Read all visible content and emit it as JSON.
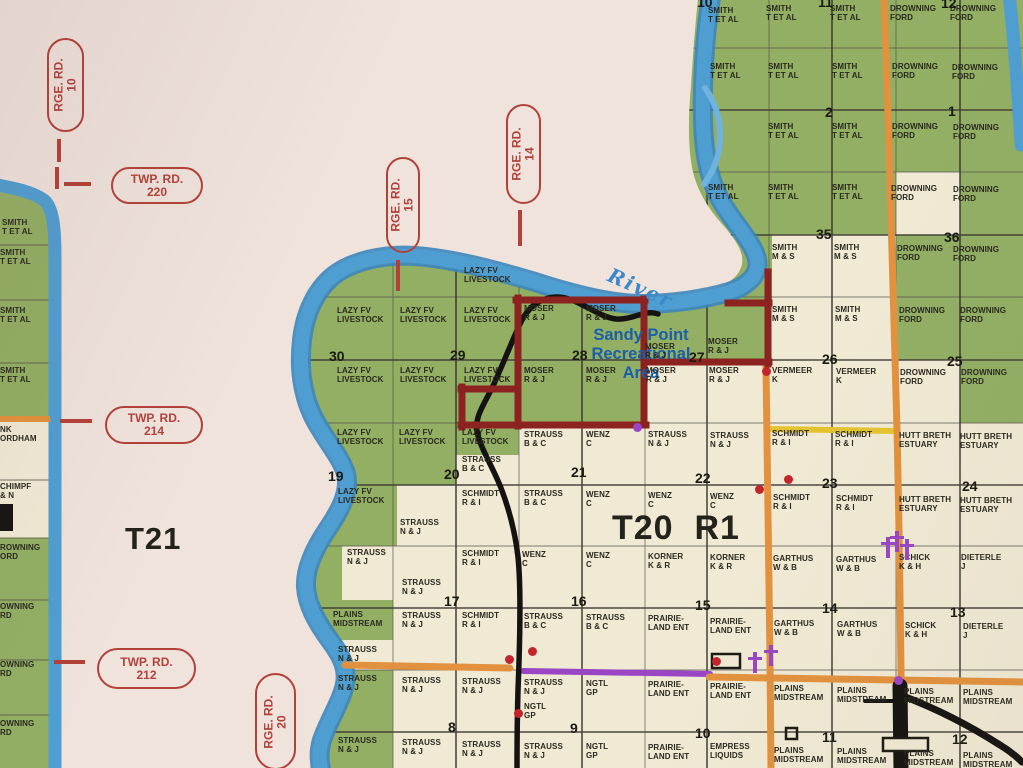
{
  "colors": {
    "paper": "#efe3dc",
    "cream": "#f0ead5",
    "green": "#92af64",
    "river": "#4f9ed2",
    "river_edge": "#3d86bd",
    "river_light": "#6fb3de",
    "grid": "#565349",
    "section_line": "#35332c",
    "orange": "#e2923e",
    "yellow": "#e3c32f",
    "purple": "#9a45c4",
    "black_road": "#151311",
    "boundary": "#8c2320",
    "oval": "#b2413a",
    "label": "#2a291f",
    "blue_text": "#1a5fa8",
    "river_text": "#3c88c8",
    "dot_red": "#c4242b"
  },
  "map": {
    "t21": "T21",
    "t20r1": "T20  R1",
    "sandy_point": [
      "Sandy Point",
      "Recreational",
      "Area"
    ],
    "river_label": "River",
    "road_ovals": [
      {
        "o": "v",
        "x": 47,
        "y": 38,
        "w": 37,
        "h": 94,
        "l1": "RGE. RD.",
        "l2": "10"
      },
      {
        "o": "h",
        "x": 111,
        "y": 167,
        "w": 92,
        "h": 37,
        "l1": "TWP. RD.",
        "l2": "220"
      },
      {
        "o": "v",
        "x": 386,
        "y": 157,
        "w": 34,
        "h": 96,
        "l1": "RGE. RD.",
        "l2": "15"
      },
      {
        "o": "v",
        "x": 506,
        "y": 104,
        "w": 35,
        "h": 100,
        "l1": "RGE. RD.",
        "l2": "14"
      },
      {
        "o": "h",
        "x": 105,
        "y": 406,
        "w": 98,
        "h": 38,
        "l1": "TWP. RD.",
        "l2": "214"
      },
      {
        "o": "h",
        "x": 97,
        "y": 648,
        "w": 99,
        "h": 41,
        "l1": "TWP. RD.",
        "l2": "212"
      },
      {
        "o": "v",
        "x": 255,
        "y": 673,
        "w": 41,
        "h": 97,
        "l1": "RGE. RD.",
        "l2": "20"
      }
    ],
    "dashes": [
      [
        57,
        139,
        4,
        23
      ],
      [
        55,
        167,
        4,
        22
      ],
      [
        64,
        182,
        27,
        4
      ],
      [
        396,
        260,
        4,
        31
      ],
      [
        518,
        210,
        4,
        36
      ],
      [
        60,
        419,
        32,
        4
      ],
      [
        54,
        660,
        31,
        4
      ]
    ],
    "orange_tick": [
      0,
      416,
      50,
      6
    ],
    "parcel_labels": [
      [
        708,
        6,
        "SMITH",
        "T ET AL"
      ],
      [
        766,
        4,
        "SMITH",
        "T ET AL"
      ],
      [
        830,
        4,
        "SMITH",
        "T ET AL"
      ],
      [
        890,
        4,
        "DROWNING",
        "FORD"
      ],
      [
        950,
        4,
        "DROWNING",
        "FORD"
      ],
      [
        710,
        62,
        "SMITH",
        "T ET AL"
      ],
      [
        768,
        62,
        "SMITH",
        "T ET AL"
      ],
      [
        832,
        62,
        "SMITH",
        "T ET AL"
      ],
      [
        892,
        62,
        "DROWNING",
        "FORD"
      ],
      [
        952,
        63,
        "DROWNING",
        "FORD"
      ],
      [
        768,
        122,
        "SMITH",
        "T ET AL"
      ],
      [
        832,
        122,
        "SMITH",
        "T ET AL"
      ],
      [
        892,
        122,
        "DROWNING",
        "FORD"
      ],
      [
        953,
        123,
        "DROWNING",
        "FORD"
      ],
      [
        708,
        183,
        "SMITH",
        "T ET AL"
      ],
      [
        768,
        183,
        "SMITH",
        "T ET AL"
      ],
      [
        832,
        183,
        "SMITH",
        "T ET AL"
      ],
      [
        891,
        184,
        "DROWNING",
        "FORD"
      ],
      [
        953,
        185,
        "DROWNING",
        "FORD"
      ],
      [
        772,
        243,
        "SMITH",
        "M & S"
      ],
      [
        834,
        243,
        "SMITH",
        "M & S"
      ],
      [
        897,
        244,
        "DROWNING",
        "FORD"
      ],
      [
        953,
        245,
        "DROWNING",
        "FORD"
      ],
      [
        464,
        266,
        "LAZY FV",
        "LIVESTOCK"
      ],
      [
        337,
        306,
        "LAZY FV",
        "LIVESTOCK"
      ],
      [
        400,
        306,
        "LAZY FV",
        "LIVESTOCK"
      ],
      [
        464,
        306,
        "LAZY FV",
        "LIVESTOCK"
      ],
      [
        524,
        304,
        "MOSER",
        "R & J"
      ],
      [
        586,
        304,
        "MOSER",
        "R & J"
      ],
      [
        645,
        342,
        "MOSER",
        "R & J"
      ],
      [
        708,
        337,
        "MOSER",
        "R & J"
      ],
      [
        772,
        305,
        "SMITH",
        "M & S"
      ],
      [
        835,
        305,
        "SMITH",
        "M & S"
      ],
      [
        899,
        306,
        "DROWNING",
        "FORD"
      ],
      [
        960,
        306,
        "DROWNING",
        "FORD"
      ],
      [
        337,
        366,
        "LAZY FV",
        "LIVESTOCK"
      ],
      [
        400,
        366,
        "LAZY FV",
        "LIVESTOCK"
      ],
      [
        464,
        366,
        "LAZY FV",
        "LIVESTOCK"
      ],
      [
        524,
        366,
        "MOSER",
        "R & J"
      ],
      [
        586,
        366,
        "MOSER",
        "R & J"
      ],
      [
        646,
        366,
        "MOSER",
        "R & J"
      ],
      [
        709,
        366,
        "MOSER",
        "R & J"
      ],
      [
        772,
        366,
        "VERMEER",
        "K"
      ],
      [
        836,
        367,
        "VERMEER",
        "K"
      ],
      [
        900,
        368,
        "DROWNING",
        "FORD"
      ],
      [
        961,
        368,
        "DROWNING",
        "FORD"
      ],
      [
        337,
        428,
        "LAZY FV",
        "LIVESTOCK"
      ],
      [
        399,
        428,
        "LAZY FV",
        "LIVESTOCK"
      ],
      [
        462,
        428,
        "LAZY FV",
        "LIVESTOCK"
      ],
      [
        462,
        455,
        "STRAUSS",
        "B & C"
      ],
      [
        524,
        430,
        "STRAUSS",
        "B & C"
      ],
      [
        586,
        430,
        "WENZ",
        "C"
      ],
      [
        648,
        430,
        "STRAUSS",
        "N & J"
      ],
      [
        710,
        431,
        "STRAUSS",
        "N & J"
      ],
      [
        772,
        429,
        "SCHMIDT",
        "R & I"
      ],
      [
        835,
        430,
        "SCHMIDT",
        "R & I"
      ],
      [
        899,
        431,
        "HUTT BRETH",
        "ESTUARY"
      ],
      [
        960,
        432,
        "HUTT BRETH",
        "ESTUARY"
      ],
      [
        338,
        487,
        "LAZY FV",
        "LIVESTOCK"
      ],
      [
        400,
        518,
        "STRAUSS",
        "N & J"
      ],
      [
        462,
        489,
        "SCHMIDT",
        "R & I"
      ],
      [
        524,
        489,
        "STRAUSS",
        "B & C"
      ],
      [
        586,
        490,
        "WENZ",
        "C"
      ],
      [
        648,
        491,
        "WENZ",
        "C"
      ],
      [
        710,
        492,
        "WENZ",
        "C"
      ],
      [
        773,
        493,
        "SCHMIDT",
        "R & I"
      ],
      [
        836,
        494,
        "SCHMIDT",
        "R & I"
      ],
      [
        899,
        495,
        "HUTT BRETH",
        "ESTUARY"
      ],
      [
        960,
        496,
        "HUTT BRETH",
        "ESTUARY"
      ],
      [
        347,
        548,
        "STRAUSS",
        "N & J"
      ],
      [
        402,
        578,
        "STRAUSS",
        "N & J"
      ],
      [
        462,
        549,
        "SCHMIDT",
        "R & I"
      ],
      [
        522,
        550,
        "WENZ",
        "C"
      ],
      [
        586,
        551,
        "WENZ",
        "C"
      ],
      [
        648,
        552,
        "KORNER",
        "K & R"
      ],
      [
        710,
        553,
        "KORNER",
        "K & R"
      ],
      [
        773,
        554,
        "GARTHUS",
        "W & B"
      ],
      [
        836,
        555,
        "GARTHUS",
        "W & B"
      ],
      [
        899,
        553,
        "SCHICK",
        "K & H"
      ],
      [
        961,
        553,
        "DIETERLE",
        "J"
      ],
      [
        333,
        610,
        "PLAINS",
        "MIDSTREAM"
      ],
      [
        338,
        645,
        "STRAUSS",
        "N & J"
      ],
      [
        402,
        611,
        "STRAUSS",
        "N & J"
      ],
      [
        462,
        611,
        "SCHMIDT",
        "R & I"
      ],
      [
        524,
        612,
        "STRAUSS",
        "B & C"
      ],
      [
        586,
        613,
        "STRAUSS",
        "B & C"
      ],
      [
        648,
        614,
        "PRAIRIE-",
        "LAND ENT"
      ],
      [
        710,
        617,
        "PRAIRIE-",
        "LAND ENT"
      ],
      [
        774,
        619,
        "GARTHUS",
        "W & B"
      ],
      [
        837,
        620,
        "GARTHUS",
        "W & B"
      ],
      [
        905,
        621,
        "SCHICK",
        "K & H"
      ],
      [
        963,
        622,
        "DIETERLE",
        "J"
      ],
      [
        338,
        674,
        "STRAUSS",
        "N & J"
      ],
      [
        402,
        676,
        "STRAUSS",
        "N & J"
      ],
      [
        462,
        677,
        "STRAUSS",
        "N & J"
      ],
      [
        524,
        678,
        "STRAUSS",
        "N & J"
      ],
      [
        524,
        702,
        "NGTL",
        "GP"
      ],
      [
        586,
        679,
        "NGTL",
        "GP"
      ],
      [
        648,
        680,
        "PRAIRIE-",
        "LAND ENT"
      ],
      [
        710,
        682,
        "PRAIRIE-",
        "LAND ENT"
      ],
      [
        774,
        684,
        "PLAINS",
        "MIDSTREAM"
      ],
      [
        837,
        686,
        "PLAINS",
        "MIDSTREAM"
      ],
      [
        904,
        687,
        "PLAINS",
        "MIDSTREAM"
      ],
      [
        963,
        688,
        "PLAINS",
        "MIDSTREAM"
      ],
      [
        338,
        736,
        "STRAUSS",
        "N & J"
      ],
      [
        402,
        738,
        "STRAUSS",
        "N & J"
      ],
      [
        462,
        740,
        "STRAUSS",
        "N & J"
      ],
      [
        524,
        742,
        "STRAUSS",
        "N & J"
      ],
      [
        586,
        742,
        "NGTL",
        "GP"
      ],
      [
        648,
        743,
        "PRAIRIE-",
        "LAND ENT"
      ],
      [
        710,
        742,
        "EMPRESS",
        "LIQUIDS"
      ],
      [
        774,
        746,
        "PLAINS",
        "MIDSTREAM"
      ],
      [
        837,
        747,
        "PLAINS",
        "MIDSTREAM"
      ],
      [
        904,
        749,
        "PLAINS",
        "MIDSTREAM"
      ],
      [
        963,
        751,
        "PLAINS",
        "MIDSTREAM"
      ],
      [
        2,
        218,
        "SMITH",
        "T ET AL"
      ],
      [
        0,
        248,
        "SMITH",
        "T ET AL"
      ],
      [
        0,
        306,
        "SMITH",
        "T ET AL"
      ],
      [
        0,
        366,
        "SMITH",
        "T ET AL"
      ],
      [
        0,
        425,
        "NK",
        "ORDHAM"
      ],
      [
        0,
        482,
        "CHIMPF",
        "& N"
      ],
      [
        0,
        543,
        "ROWNING",
        "ORD"
      ],
      [
        0,
        602,
        "OWNING",
        "RD"
      ],
      [
        0,
        660,
        "OWNING",
        "RD"
      ],
      [
        0,
        719,
        "OWNING",
        "RD"
      ]
    ],
    "section_numbers": [
      [
        697,
        -5,
        "10"
      ],
      [
        818,
        -5,
        "11"
      ],
      [
        941,
        -4,
        "12"
      ],
      [
        825,
        105,
        "2"
      ],
      [
        948,
        104,
        "1"
      ],
      [
        816,
        227,
        "35"
      ],
      [
        944,
        230,
        "36"
      ],
      [
        329,
        349,
        "30"
      ],
      [
        450,
        348,
        "29"
      ],
      [
        572,
        348,
        "28"
      ],
      [
        689,
        350,
        "27"
      ],
      [
        822,
        352,
        "26"
      ],
      [
        947,
        354,
        "25"
      ],
      [
        328,
        469,
        "19"
      ],
      [
        444,
        467,
        "20"
      ],
      [
        571,
        465,
        "21"
      ],
      [
        695,
        471,
        "22"
      ],
      [
        822,
        476,
        "23"
      ],
      [
        962,
        479,
        "24"
      ],
      [
        444,
        594,
        "17"
      ],
      [
        571,
        594,
        "16"
      ],
      [
        695,
        598,
        "15"
      ],
      [
        822,
        601,
        "14"
      ],
      [
        950,
        605,
        "13"
      ],
      [
        448,
        720,
        "8"
      ],
      [
        570,
        721,
        "9"
      ],
      [
        695,
        726,
        "10"
      ],
      [
        822,
        730,
        "11"
      ],
      [
        952,
        732,
        "12"
      ]
    ],
    "symbols": {
      "red_dots": [
        [
          766,
          371
        ],
        [
          788,
          479
        ],
        [
          759,
          489
        ],
        [
          509,
          659
        ],
        [
          532,
          651
        ],
        [
          518,
          713
        ],
        [
          716,
          661
        ]
      ],
      "purple_dots": [
        [
          637,
          427
        ],
        [
          898,
          680
        ]
      ],
      "crosses": [
        [
          755,
          662
        ],
        [
          771,
          655
        ],
        [
          888,
          547
        ],
        [
          897,
          541
        ],
        [
          907,
          549
        ]
      ]
    }
  }
}
